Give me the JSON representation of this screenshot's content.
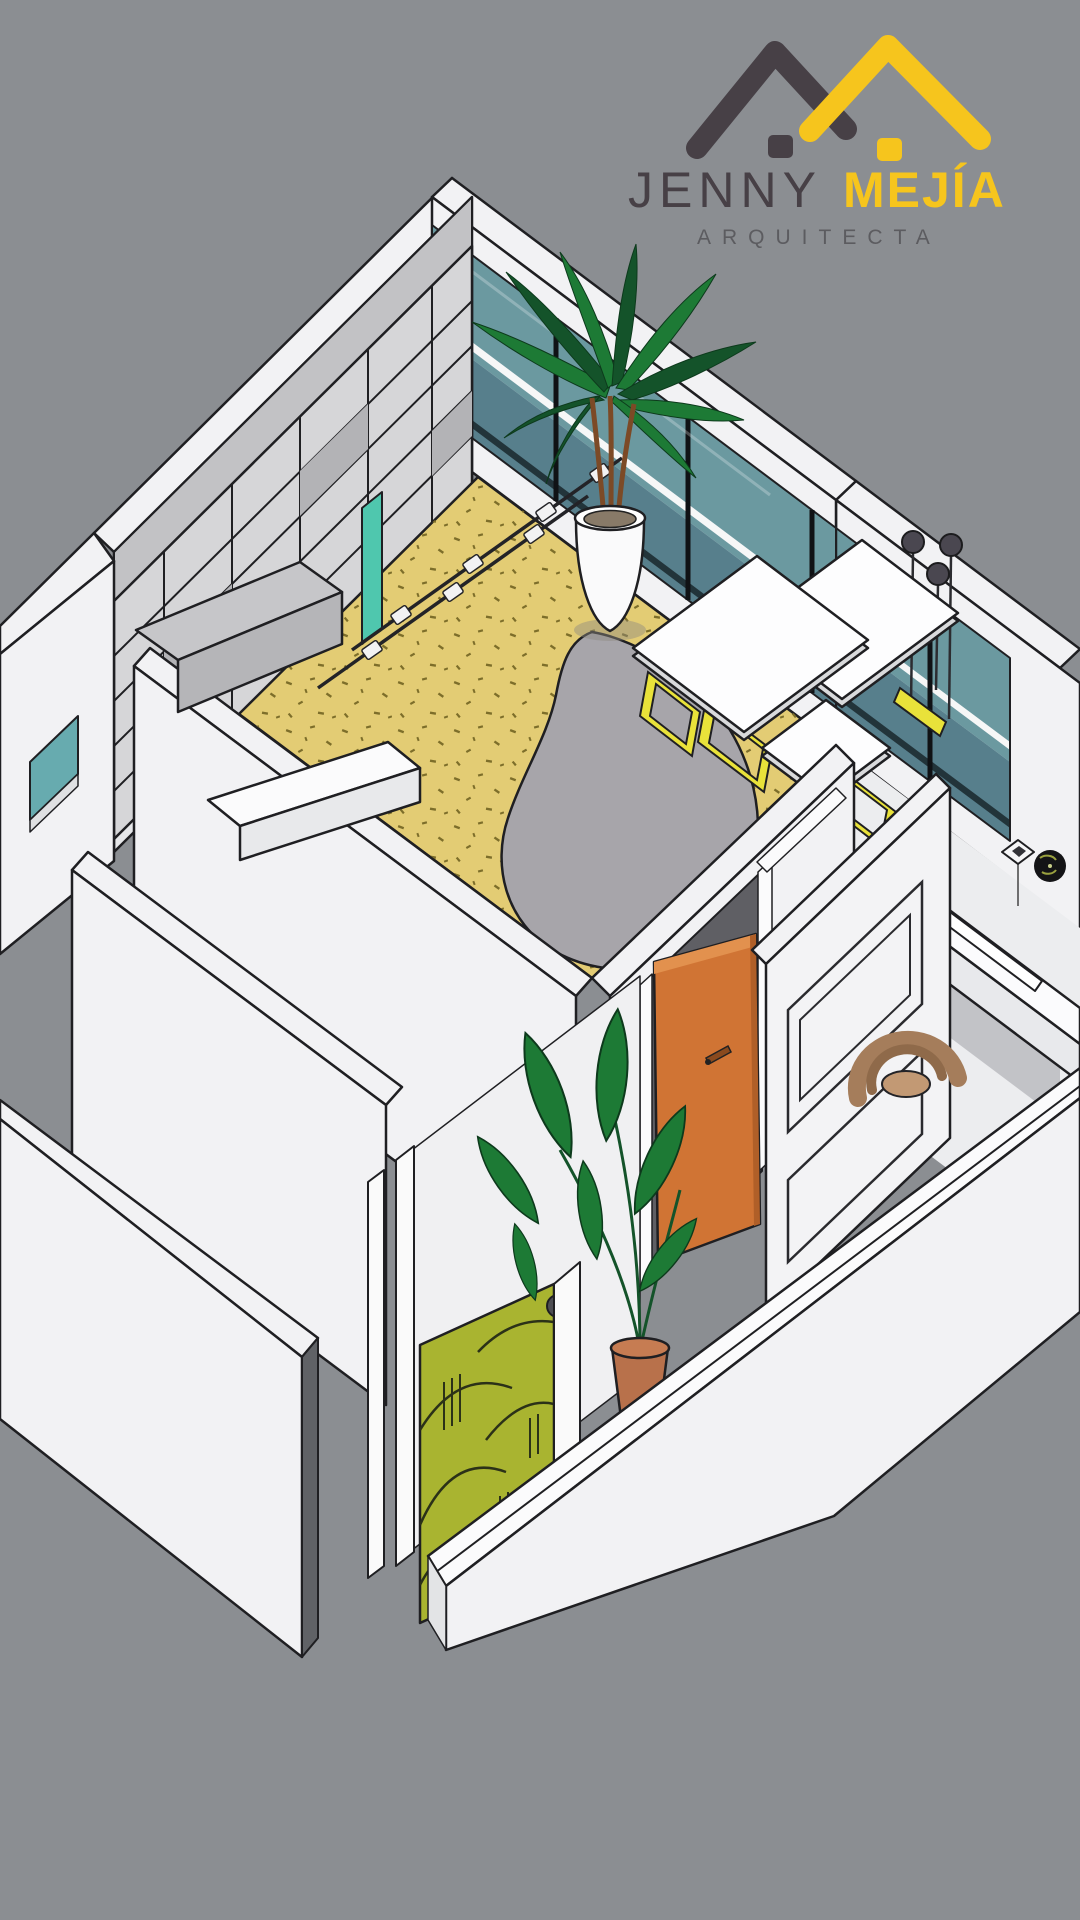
{
  "brand": {
    "first_name": "JENNY",
    "last_name": "MEJÍA",
    "tagline": "ARQUITECTA"
  },
  "palette": {
    "bg": "#8b8e92",
    "wall_white": "#f2f2f4",
    "wall_shade": "#e6e7e9",
    "outline": "#1f1f22",
    "floor_yellow": "#e3cc74",
    "floor_speckle": "#7d6e2a",
    "glass_teal": "#6b99a0",
    "glass_teal_dark": "#577f8c",
    "glass_stripe": "#22343a",
    "mirror_teal": "#4fc7ae",
    "shelf_gray": "#d6d6d8",
    "shelf_gray_top": "#c2c2c5",
    "shelf_gray_dark": "#b3b3b6",
    "rug_gray": "#a7a5aa",
    "accent_yellow": "#e9e23a",
    "door_orange": "#d07434",
    "door_orange_dark": "#b05f28",
    "door_orange_light": "#e2914e",
    "plant_green": "#1d7a35",
    "plant_green_dark": "#14532a",
    "terracotta": "#b8714b",
    "chair_brown": "#a57d5b",
    "panel_olive": "#a9b430",
    "pendant_gray": "#4a4750",
    "cut_gray": "#606266",
    "logo_charcoal": "#474046",
    "logo_yellow": "#f6c51d",
    "tagline_gray": "#5c5c60"
  },
  "scene": {
    "type": "isometric-apartment-cutaway",
    "objects": [
      "wardrobe-shelving-wall",
      "leaning-mirror",
      "track-light-rails",
      "window-wall-teal-glass",
      "pendant-lamps",
      "palm-plant-in-white-pot",
      "speckled-yellow-floor",
      "gray-organic-rug",
      "white-tables-yellow-trestles",
      "orange-entry-door",
      "paneled-molding-wall",
      "white-desk-with-ledge",
      "rattan-chair",
      "wall-plate-decor",
      "square-ceiling-light",
      "small-room-teal-window",
      "gray-counter",
      "white-shelf",
      "olive-pattern-art-panel",
      "banana-plant-terracotta-pot",
      "perimeter-walls"
    ]
  }
}
